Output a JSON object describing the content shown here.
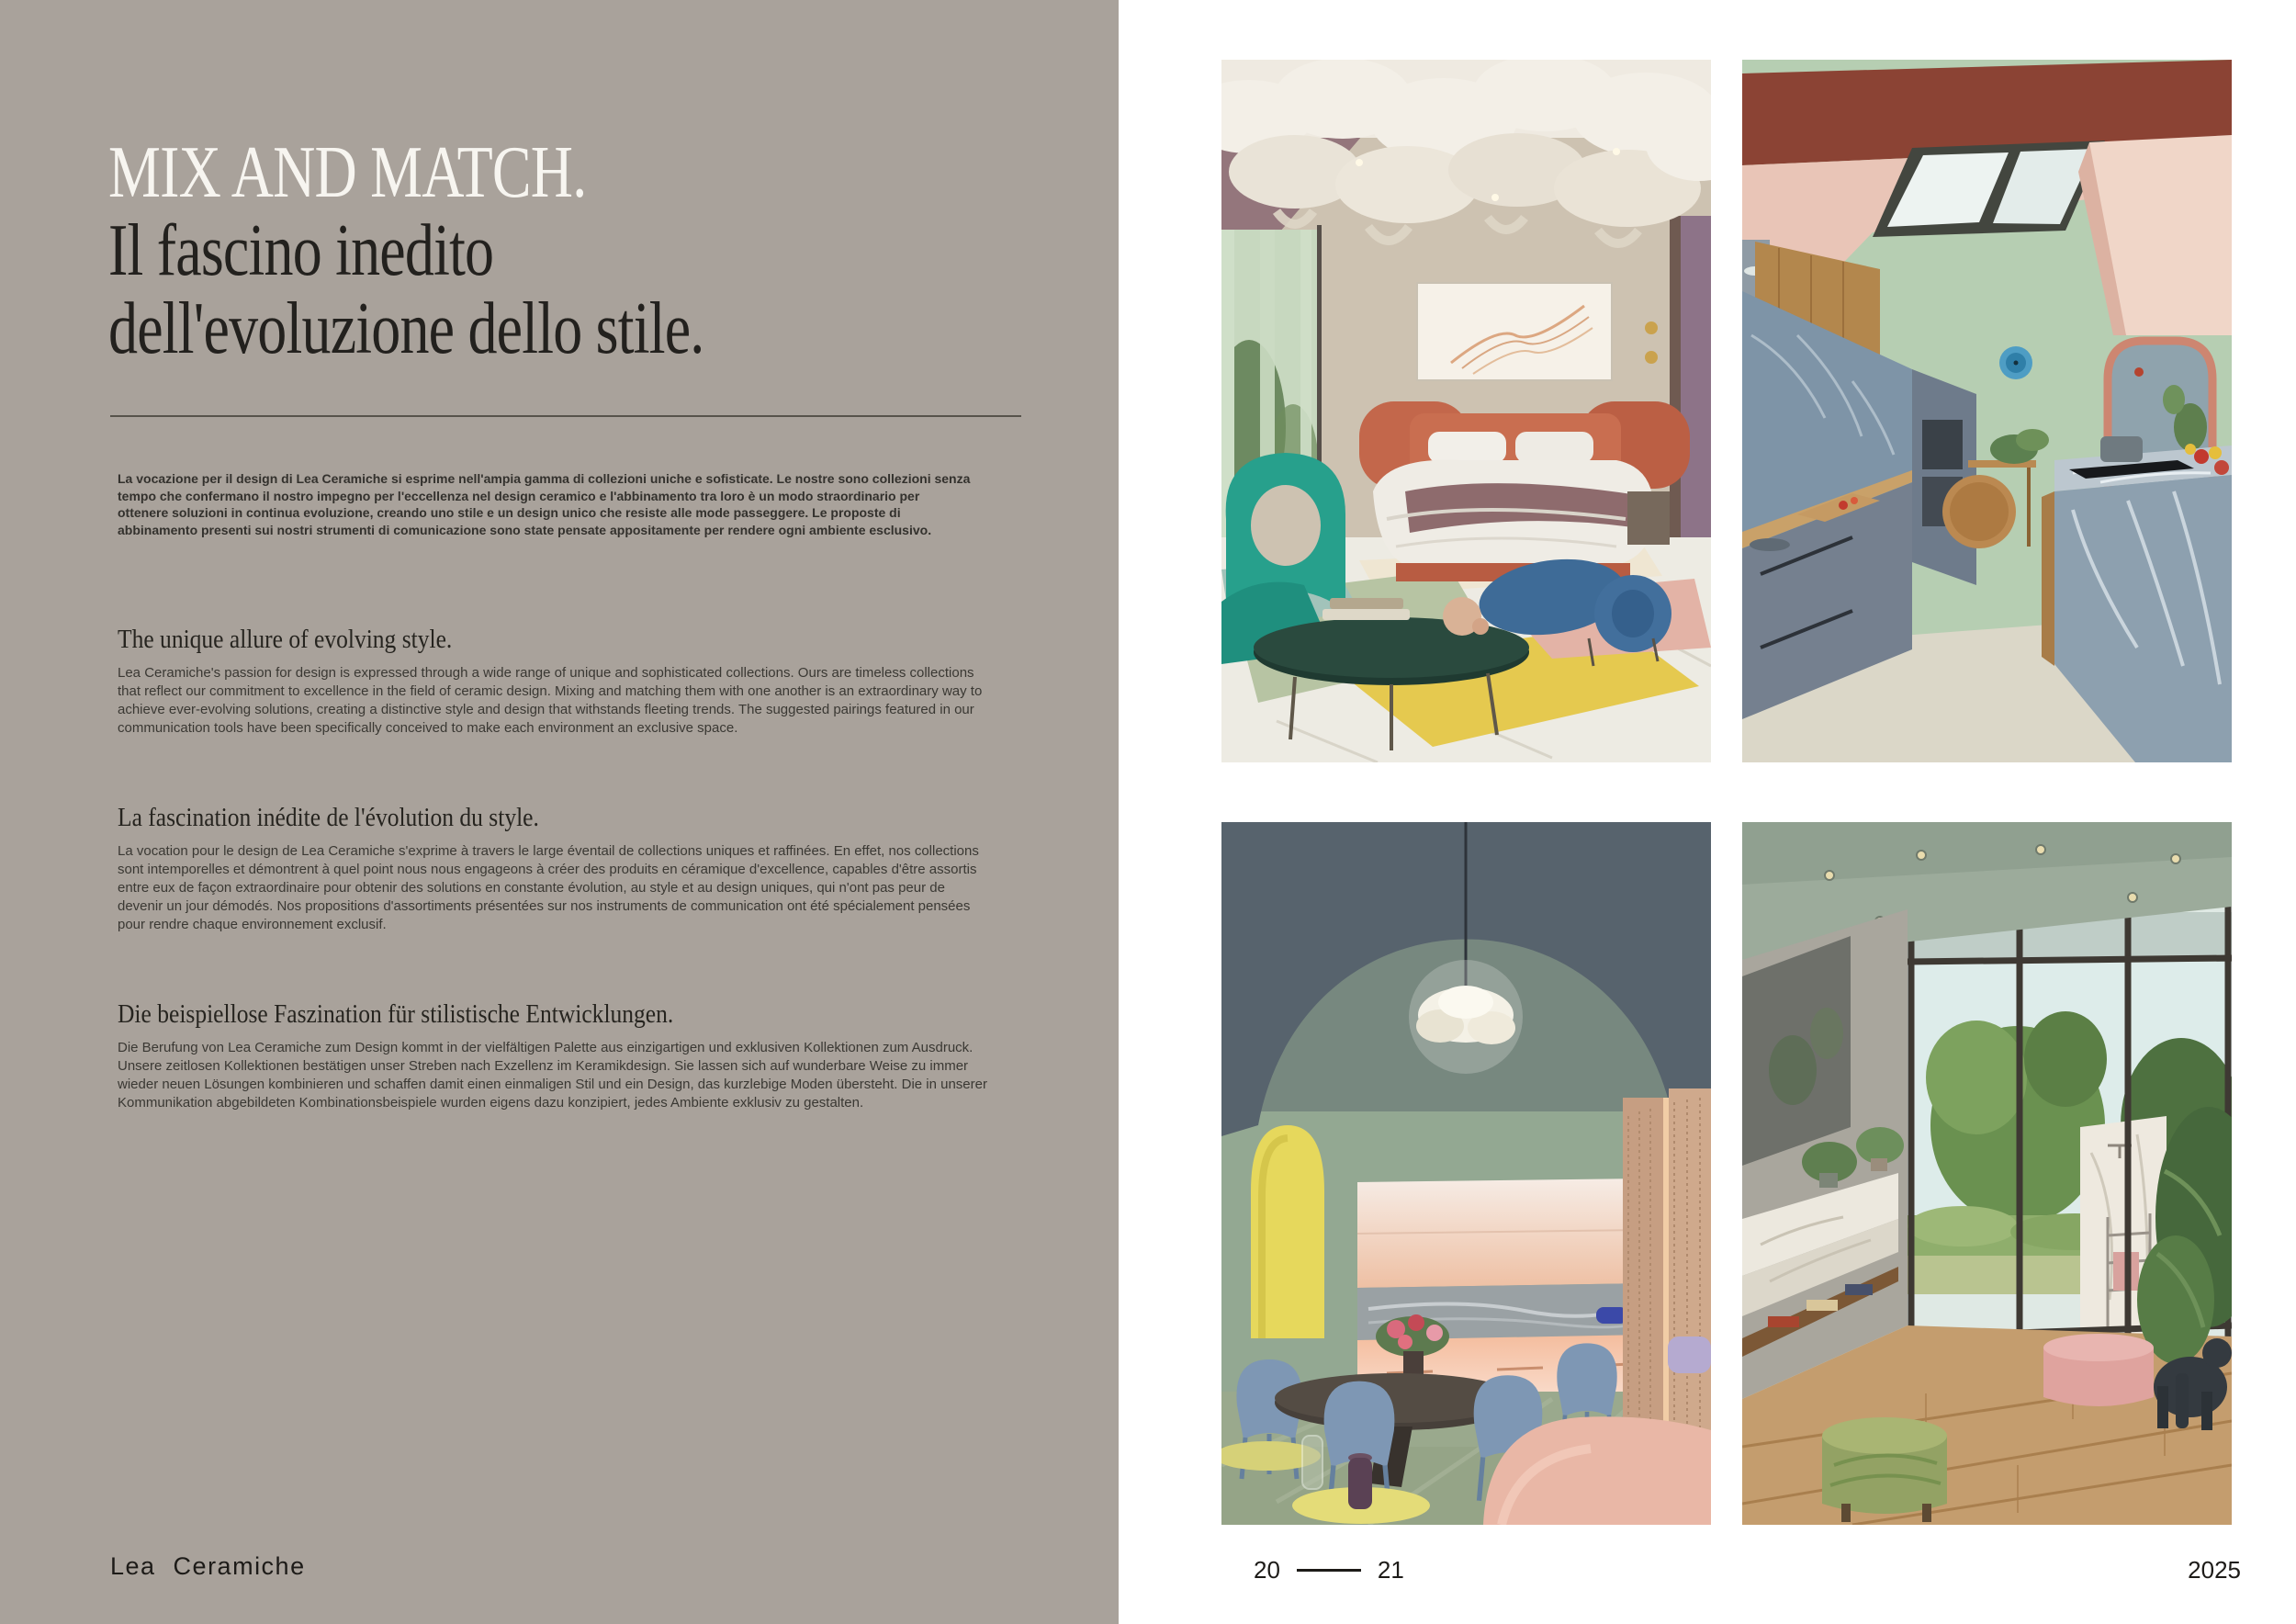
{
  "left": {
    "title_lines": [
      "MIX AND MATCH.",
      "Il fascino inedito",
      "dell'evoluzione dello stile."
    ],
    "intro_it": "La vocazione per il design di Lea Ceramiche si esprime nell'ampia gamma di collezioni uniche e sofisticate. Le nostre sono collezioni senza tempo che confermano il nostro impegno per l'eccellenza nel design ceramico e l'abbinamento tra loro è un modo straordinario per ottenere soluzioni in continua evoluzione, creando uno stile e un design unico che resiste alle mode passeggere. Le proposte di abbinamento presenti sui nostri strumenti di comunicazione sono state pensate appositamente per rendere ogni ambiente esclusivo.",
    "sections": [
      {
        "lang": "en",
        "heading": "The unique allure of evolving style.",
        "body": "Lea Ceramiche's passion for design is expressed through a wide range of unique and sophisticated collections. Ours are timeless collections that reflect our commitment to excellence in the field of ceramic design. Mixing and matching them with one another is an extraordinary way to achieve ever-evolving solutions, creating a distinctive style and design that withstands fleeting trends. The suggested pairings featured in our communication tools have been specifically conceived to make each environment an exclusive space."
      },
      {
        "lang": "fr",
        "heading": "La fascination inédite de l'évolution du style.",
        "body": "La vocation pour le design de Lea Ceramiche s'exprime à travers le large éventail de collections uniques et raffinées. En effet, nos collections sont intemporelles et démontrent à quel point nous nous engageons à créer des produits en céramique d'excellence, capables d'être assortis entre eux de façon extraordinaire pour obtenir des solutions en constante évolution, au style et au design uniques, qui n'ont pas peur de devenir un jour démodés. Nos propositions d'assortiments présentées sur nos instruments de communication ont été spécialement pensées pour rendre chaque environnement exclusif."
      },
      {
        "lang": "de",
        "heading": "Die beispiellose Faszination für stilistische Entwicklungen.",
        "body": "Die Berufung von Lea Ceramiche zum Design kommt in der vielfältigen Palette aus einzigartigen und exklusiven Kollektionen zum Ausdruck. Unsere zeitlosen Kollektionen bestätigen unser Streben nach Exzellenz im Keramikdesign. Sie lassen sich auf wunderbare Weise zu immer wieder neuen Lösungen kombinieren und schaffen damit einen einmaligen Stil und ein Design, das kurzlebige Moden übersteht. Die in unserer Kommunikation abgebildeten Kombinationsbeispiele wurden eigens dazu konzipiert, jedes Ambiente exklusiv zu gestalten."
      }
    ],
    "footer_brand": "Lea Ceramiche"
  },
  "right": {
    "page_left": "20",
    "page_right": "21",
    "year": "2025"
  },
  "photos": [
    "bedroom-with-fabric-ceiling-installation",
    "kitchen-with-skylight-and-marble-island",
    "dining-room-with-vaulted-ceiling",
    "indoor-outdoor-bathroom-with-garden-view"
  ],
  "colors": {
    "page_bg": "#a9a29b",
    "paper": "#ffffff",
    "text_dark": "#1f1e1b",
    "title_white": "#f7f5f0"
  }
}
